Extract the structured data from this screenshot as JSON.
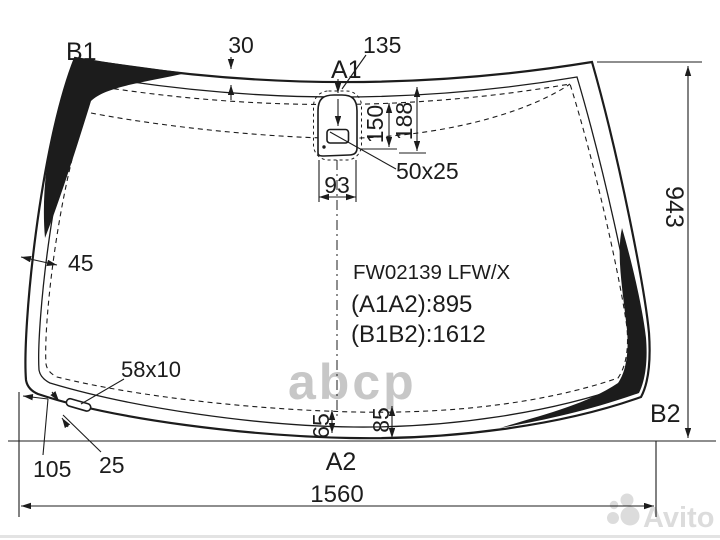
{
  "diagram": {
    "part_number": "FW02139 LFW/X",
    "distance_a1a2": "(A1A2):895",
    "distance_b1b2": "(B1B2):1612",
    "labels": {
      "b1": "B1",
      "a1": "A1",
      "a2": "A2",
      "b2": "B2"
    },
    "dimensions": {
      "top_band": "30",
      "mount_offset": "135",
      "mount_height_inner": "150",
      "mount_height_outer": "188",
      "mount_width": "93",
      "sensor_window": "50x25",
      "left_band": "45",
      "glass_height": "943",
      "slot_size": "58x10",
      "slot_from_edge": "105",
      "slot_offset": "25",
      "bottom_band_inner": "65",
      "bottom_band_outer": "85",
      "glass_width": "1560"
    }
  },
  "watermarks": {
    "abcp": "abcp",
    "avito": "Avito"
  },
  "colors": {
    "line": "#1c1c1c",
    "watermark": "#c7c7c7",
    "watermark_light": "#dcdcdc"
  }
}
